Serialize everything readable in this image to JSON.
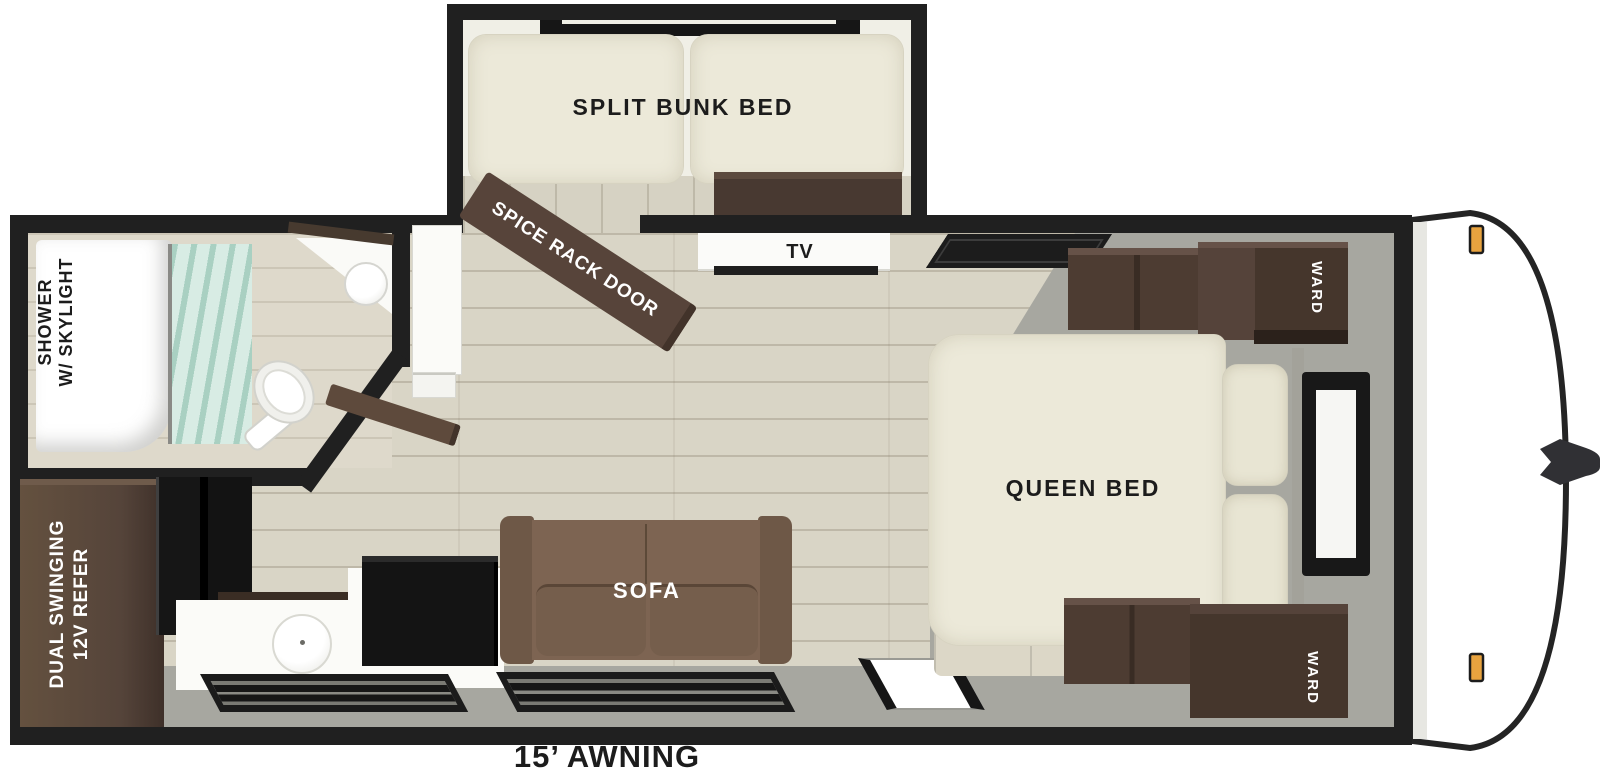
{
  "title": "Travel trailer floor plan",
  "labels": {
    "bunk": "SPLIT BUNK BED",
    "spice_rack": "SPICE RACK DOOR",
    "tv": "TV",
    "shower": {
      "line1": "SHOWER",
      "line2": "W/ SKYLIGHT"
    },
    "queen": "QUEEN BED",
    "ward": "WARD",
    "refer": {
      "line1": "DUAL SWINGING",
      "line2": "12V REFER"
    },
    "sofa": "SOFA",
    "awning": "15’ AWNING"
  },
  "colors": {
    "wall_black": "#202020",
    "floor_wood": "#d9d5c6",
    "floor_gray": "#a7a7a0",
    "mattress_cream": "#ece9d9",
    "furniture_brown": "#4d3c32",
    "sofa_brown": "#7d6452",
    "appliance_black": "#141414",
    "curtain_teal": "#d8ece4",
    "marker_amber": "#e8a33f",
    "cap_white": "#ffffff"
  }
}
